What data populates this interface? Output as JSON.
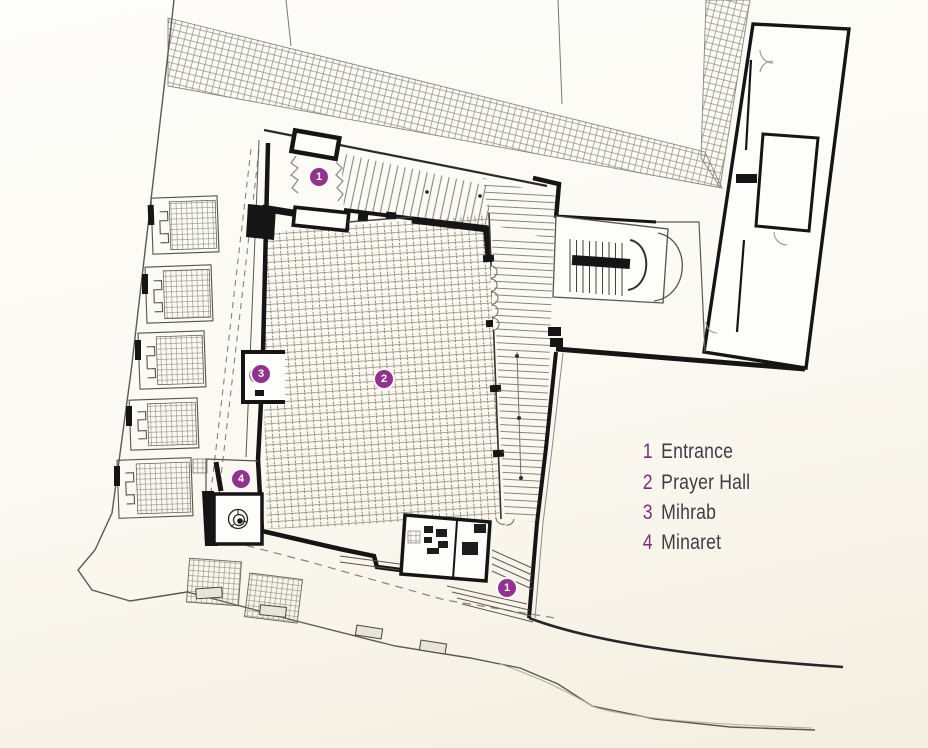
{
  "legend": {
    "items": [
      {
        "number": "1",
        "label": "Entrance"
      },
      {
        "number": "2",
        "label": "Prayer Hall"
      },
      {
        "number": "3",
        "label": "Mihrab"
      },
      {
        "number": "4",
        "label": "Minaret"
      }
    ]
  },
  "markers": {
    "entrance_top": "1",
    "prayer_hall": "2",
    "mihrab": "3",
    "minaret": "4",
    "entrance_bottom": "1"
  },
  "colors": {
    "marker_fill": "#93328e",
    "legend_number": "#7a2c7e",
    "legend_text": "#3d3d45",
    "ink": "#151515",
    "hatch": "#8d8b7c",
    "paper": "#fbf9f2"
  }
}
